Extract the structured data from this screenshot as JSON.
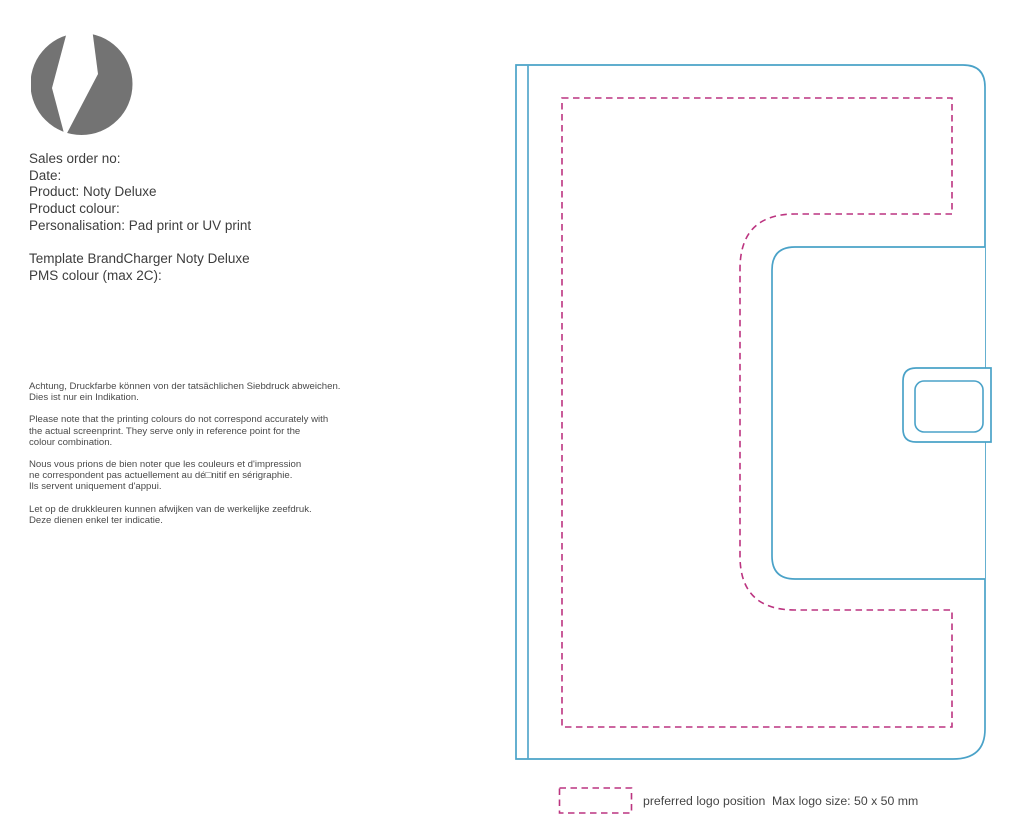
{
  "logo": {
    "icon": "lightning-bolt-icon",
    "circle_color": "#737373",
    "bolt_color": "#ffffff"
  },
  "order_info": {
    "lines": [
      "Sales order no:",
      "Date:",
      "Product: Noty Deluxe",
      "Product colour:",
      "Personalisation: Pad print or UV print"
    ]
  },
  "template_info": {
    "lines": [
      "Template BrandCharger Noty Deluxe",
      "PMS colour (max 2C):"
    ]
  },
  "disclaimers": {
    "de": {
      "lines": [
        "Achtung, Druckfarbe können von der tatsächlichen Siebdruck abweichen.",
        "Dies ist nur ein Indikation."
      ]
    },
    "en": {
      "lines": [
        "Please note that the printing colours do not correspond accurately with",
        "the actual screenprint. They serve only in reference point for the",
        "colour combination."
      ]
    },
    "fr": {
      "lines": [
        "Nous vous prions de bien noter que les couleurs et d'impression",
        "ne correspondent pas actuellement au dé□nitif en sérigraphie.",
        "Ils servent uniquement d'appui."
      ]
    },
    "nl": {
      "lines": [
        "Let op de drukkleuren kunnen afwijken van de werkelijke zeefdruk.",
        "Deze dienen enkel ter indicatie."
      ]
    }
  },
  "diagram": {
    "outline_color": "#4aa2c8",
    "dash_color": "#bc3480",
    "fill_color": "#ffffff"
  },
  "legend": {
    "swatch_color": "#bc3480",
    "label": "preferred logo position",
    "max_size_note": "Max logo size: 50 x 50 mm"
  }
}
